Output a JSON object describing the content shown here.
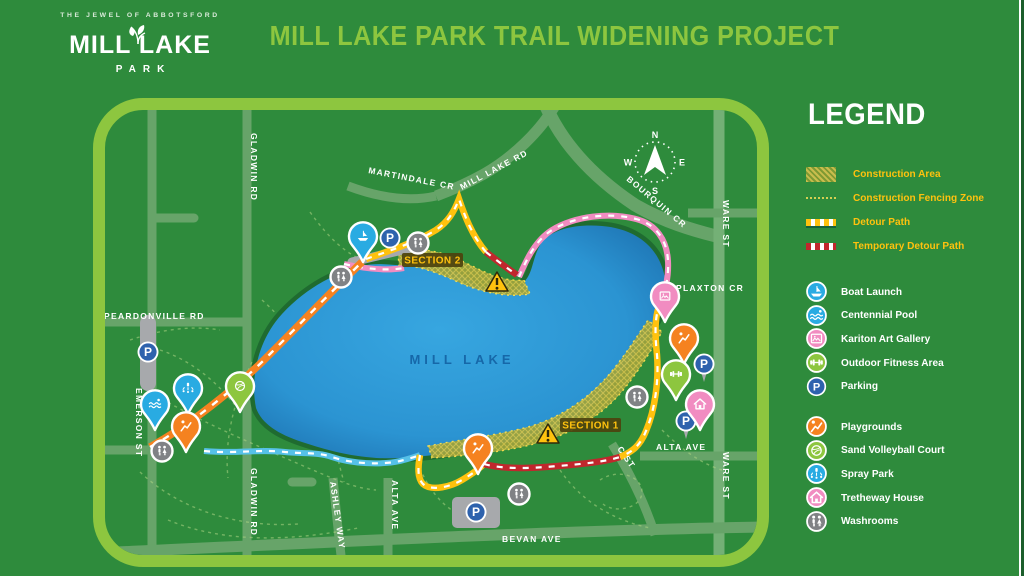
{
  "header": {
    "tagline": "THE JEWEL OF ABBOTSFORD",
    "logo_line1": "MILL LAKE",
    "logo_line2": "PARK",
    "title": "MILL LAKE PARK TRAIL WIDENING PROJECT"
  },
  "legend": {
    "title": "LEGEND",
    "line_items": [
      {
        "label": "Construction Area",
        "type": "construction-area"
      },
      {
        "label": "Construction Fencing Zone",
        "type": "construction-fencing-zone"
      },
      {
        "label": "Detour Path",
        "type": "detour-path"
      },
      {
        "label": "Temporary Detour Path",
        "type": "temporary-detour-path"
      }
    ],
    "poi_items": [
      {
        "label": "Boat Launch",
        "icon": "boat-icon",
        "color": "#29abe2"
      },
      {
        "label": "Centennial Pool",
        "icon": "pool-icon",
        "color": "#29abe2"
      },
      {
        "label": "Kariton Art Gallery",
        "icon": "art-gallery-icon",
        "color": "#f18cc1"
      },
      {
        "label": "Outdoor Fitness Area",
        "icon": "fitness-icon",
        "color": "#8dc63f"
      },
      {
        "label": "Parking",
        "icon": "parking-icon",
        "color": "#2e62ad"
      },
      {
        "label": "Playgrounds",
        "icon": "playground-icon",
        "color": "#f58220"
      },
      {
        "label": "Sand Volleyball Court",
        "icon": "volleyball-icon",
        "color": "#8dc63f"
      },
      {
        "label": "Spray Park",
        "icon": "spray-park-icon",
        "color": "#29abe2"
      },
      {
        "label": "Tretheway House",
        "icon": "house-icon",
        "color": "#f18cc1"
      },
      {
        "label": "Washrooms",
        "icon": "washroom-icon",
        "color": "#808285"
      }
    ]
  },
  "map": {
    "lake_label": "MILL LAKE",
    "parking_letter": "P",
    "compass": {
      "n": "N",
      "e": "E",
      "s": "S",
      "w": "W"
    },
    "sections": [
      {
        "label": "SECTION 1"
      },
      {
        "label": "SECTION 2"
      }
    ],
    "roads": [
      {
        "label": "GLADWIN RD"
      },
      {
        "label": "GLADWIN RD"
      },
      {
        "label": "PEARDONVILLE RD"
      },
      {
        "label": "EMERSON ST"
      },
      {
        "label": "MARTINDALE CR"
      },
      {
        "label": "MILL LAKE RD"
      },
      {
        "label": "BOURQUIN CR"
      },
      {
        "label": "WARE ST"
      },
      {
        "label": "WARE ST"
      },
      {
        "label": "PLAXTON CR"
      },
      {
        "label": "ALTA AVE"
      },
      {
        "label": "ALTA AVE"
      },
      {
        "label": "ASHLEY WAY"
      },
      {
        "label": "C ST"
      },
      {
        "label": "BEVAN AVE"
      }
    ],
    "markers": {
      "pins": [
        "boat-launch",
        "centennial-pool",
        "spray-park",
        "playgrounds",
        "sand-volleyball-court",
        "kariton-art-gallery",
        "playgrounds",
        "outdoor-fitness-area",
        "tretheway-house",
        "playgrounds"
      ],
      "parking_spots": 5,
      "washrooms": 5,
      "warning_signs": 2
    }
  },
  "colors": {
    "background": "#2e8b3c",
    "frame": "#8dc63f",
    "title": "#8dc63f",
    "legend_label": "#ffc20e",
    "lake": "#2d9fdc",
    "detour_path": "#ffc20e",
    "temporary_detour_path": "#c1272d",
    "trail_pink": "#f18cc1",
    "trail_blue": "#56c1e8",
    "trail_orange": "#f58220"
  }
}
